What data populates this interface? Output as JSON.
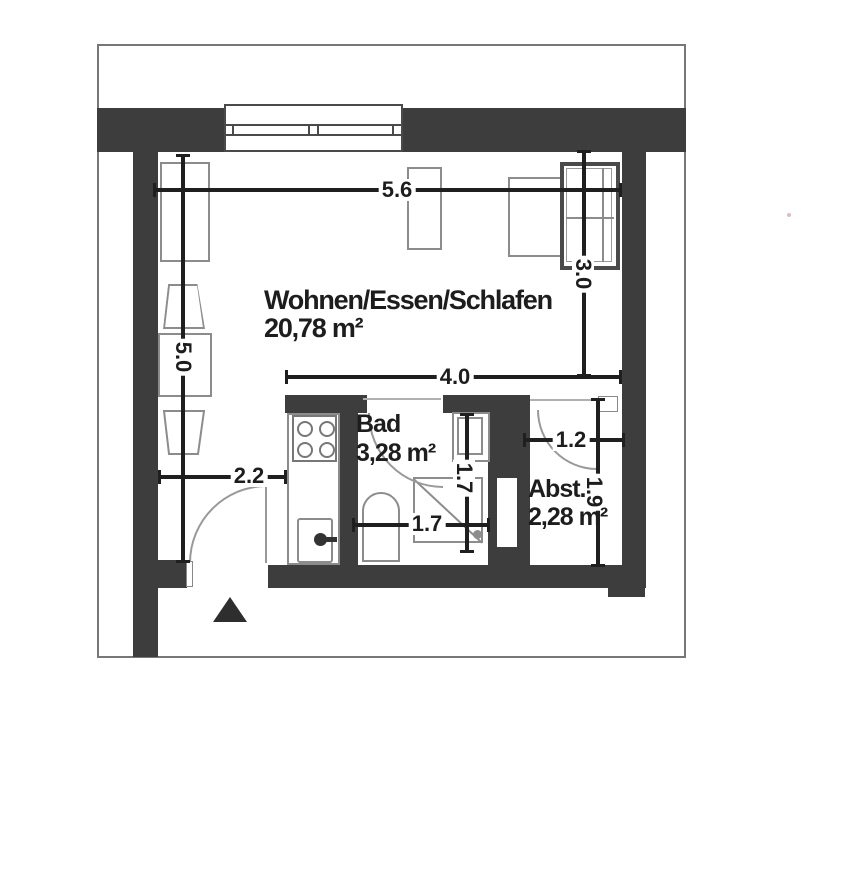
{
  "plan": {
    "title": "Apartment floor plan",
    "rooms": {
      "living": {
        "name": "Wohnen/Essen/Schlafen",
        "area": "20,78 m²"
      },
      "bath": {
        "name": "Bad",
        "area": "3,28 m²"
      },
      "storage": {
        "name": "Abst.",
        "area": "2,28 m²"
      }
    },
    "dimensions": {
      "top_width": "5.6",
      "bed_depth": "3.0",
      "left_height": "5.0",
      "mid_width": "4.0",
      "entry_width": "2.2",
      "storage_width": "1.2",
      "bath_height": "1.7",
      "bath_width": "1.7",
      "storage_height": "1.9"
    },
    "colors": {
      "wall": "#3d3d3d",
      "dim": "#1f1f1f",
      "furn": "#8c8c8c",
      "ink": "#1d1d1d",
      "frame": "#777777"
    }
  }
}
